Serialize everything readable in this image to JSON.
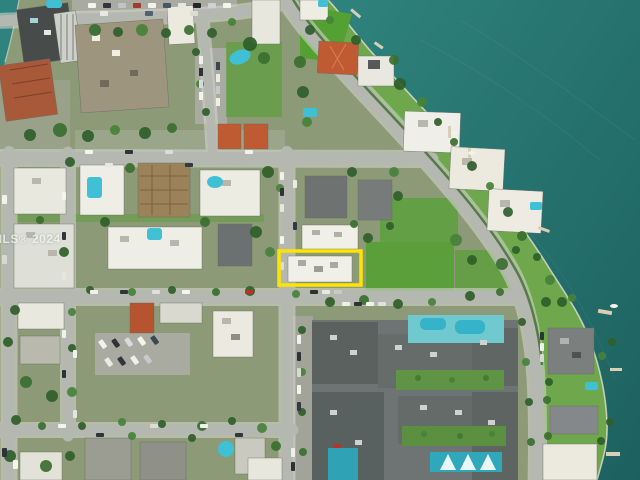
{
  "image": {
    "type": "aerial-drone-photo",
    "scene": "Aerial view of waterfront residential neighborhood with subject property outlined in yellow",
    "watermark": "MLS® 2024"
  },
  "highlight": {
    "label": "subject-property-outline",
    "color": "#ffe400"
  },
  "colors": {
    "water": "#2f837e",
    "water_deep": "#1d615f",
    "land": "#8d9a77",
    "lawn": "#6fa74c",
    "lawn_bright": "#55a033",
    "road": "#b5b8b1",
    "sidewalk": "#d9d9d1",
    "roof_white": "#f0efe8",
    "roof_gray": "#75797a",
    "roof_dark": "#565c5b",
    "roof_tan": "#9e957f",
    "roof_rust": "#a8593a",
    "roof_red": "#c05a32",
    "pool": "#3fc0d4",
    "tree": "#2f5f2b",
    "shoreline": "#e9e7da"
  }
}
